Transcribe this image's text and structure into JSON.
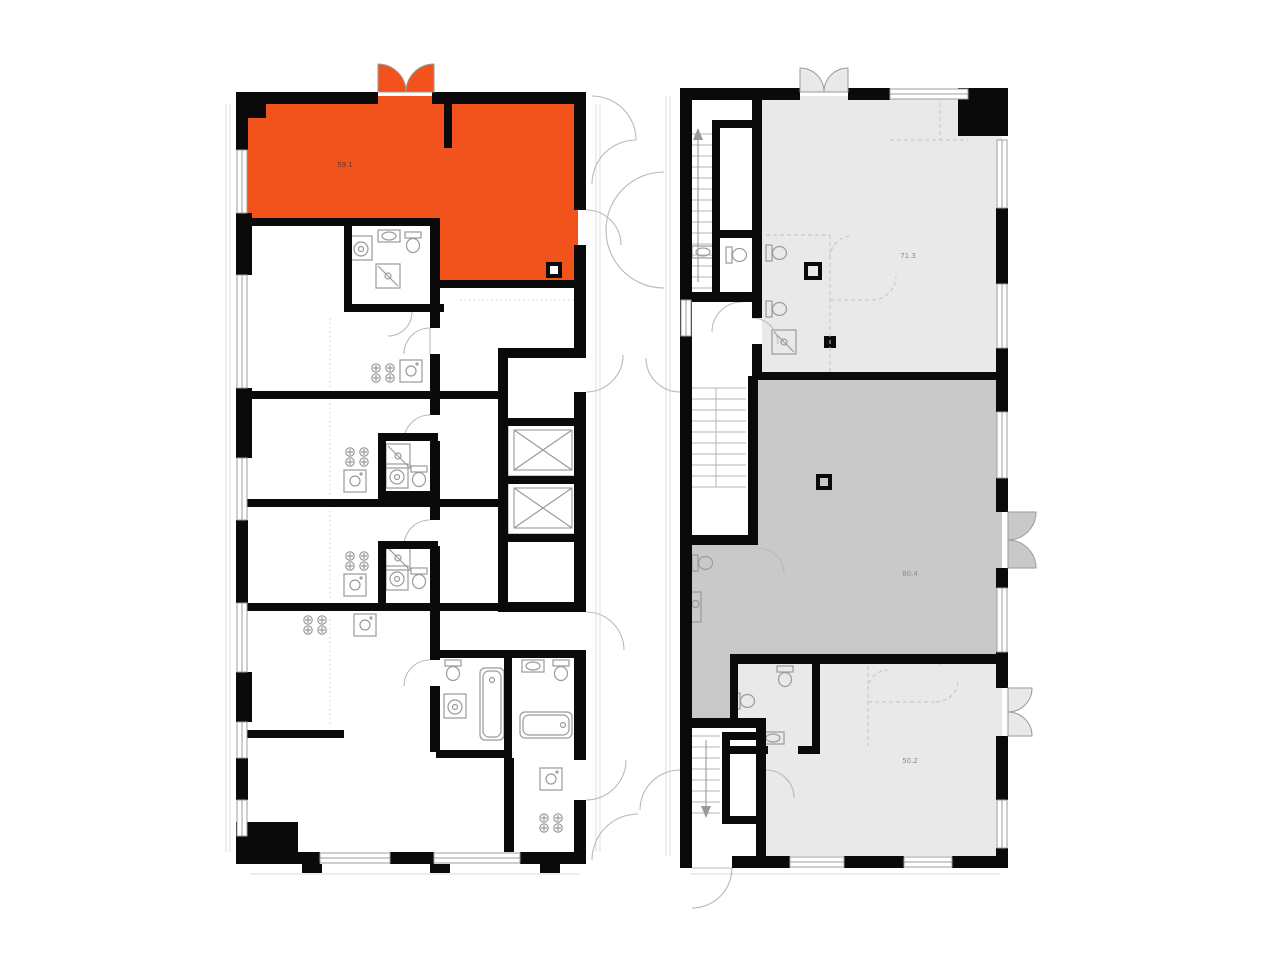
{
  "page": {
    "title": "Residential floor plan with highlighted unit"
  },
  "colors": {
    "background": "#ffffff",
    "selected_unit": "#F2531D",
    "unit_light": "#E9E9E9",
    "unit_dark": "#C9C9C9",
    "wall": "#0A0A0A",
    "thin_line": "#9E9E9E",
    "door_arc": "#B9B9B9",
    "fixture_line": "#9A9A9A",
    "selected_label": "#5B382A",
    "gray_label": "#8C8C8C"
  },
  "units": {
    "selected": {
      "area_label": "59.1"
    },
    "top_right": {
      "area_label": "71.3"
    },
    "middle_right": {
      "area_label": "80.4"
    },
    "bottom_right": {
      "area_label": "50.2"
    }
  },
  "icons": {
    "elevator": "crossed-box",
    "stairs_up": "treads-with-up-arrow",
    "stairs_down": "treads-with-down-arrow",
    "door": "quarter-circle-swing",
    "window": "double-line-in-wall",
    "bathtub": "rounded-rect-with-drain",
    "shower": "square-with-diagonal",
    "toilet": "tank-and-bowl",
    "sink": "rect-with-circle",
    "stove": "four-crossed-burners",
    "washer": "square-with-drum"
  }
}
